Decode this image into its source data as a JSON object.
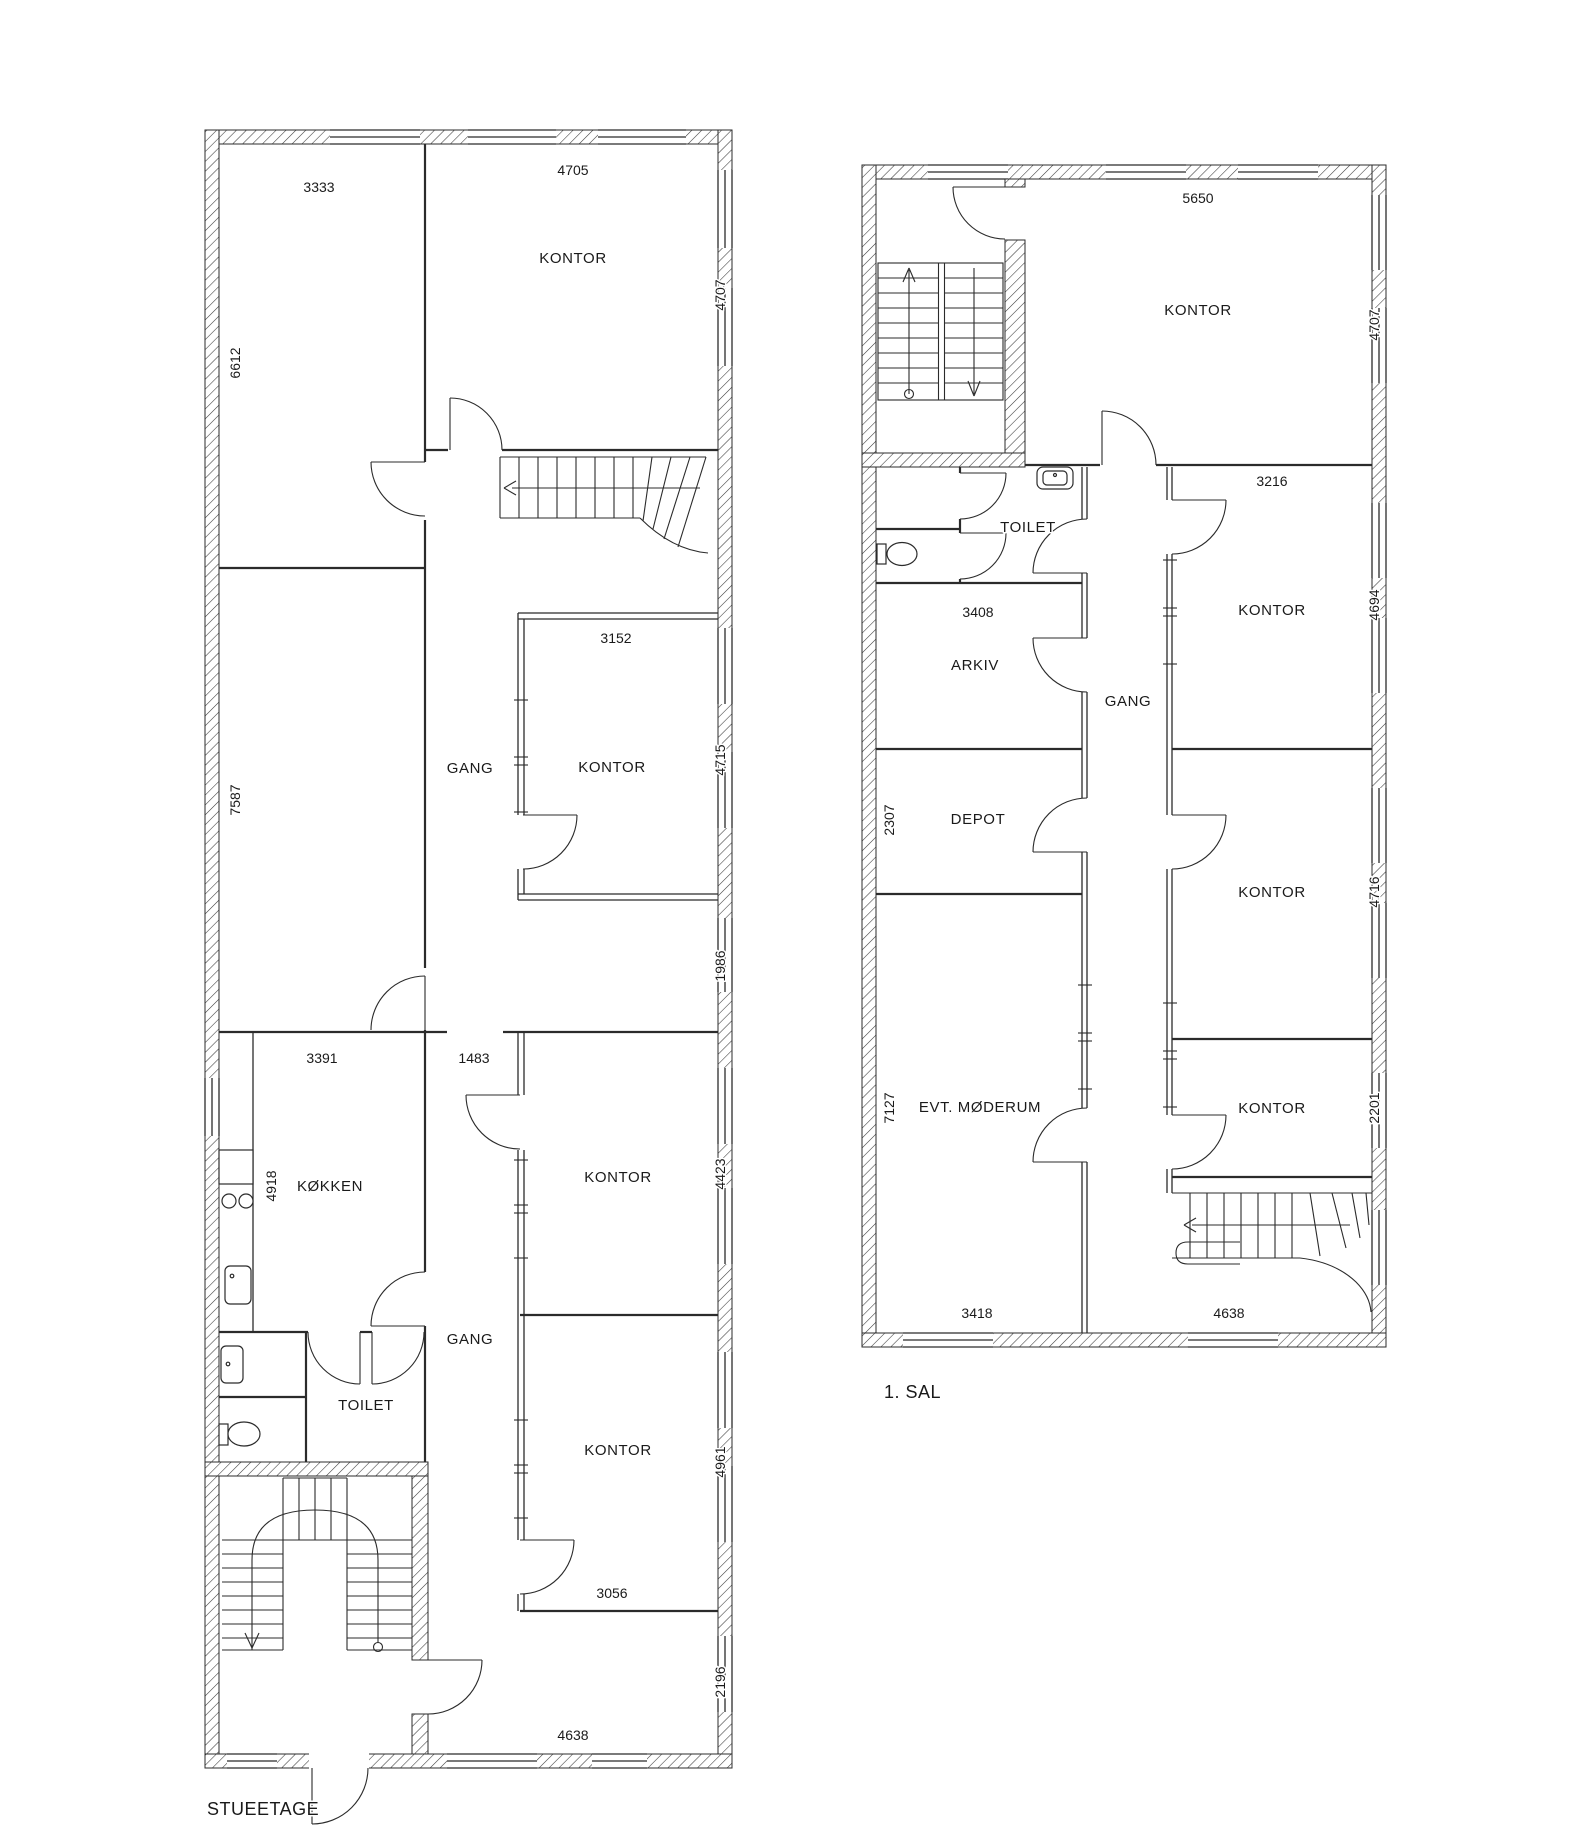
{
  "page": {
    "background": "#ffffff",
    "line_color": "#2b2b2b",
    "text_color": "#1a1a1a"
  },
  "ground": {
    "title": "STUEETAGE",
    "rooms": {
      "kontor_ne": "KONTOR",
      "kontor_inner": "KONTOR",
      "kontor_mid": "KONTOR",
      "kontor_low": "KONTOR",
      "kokken": "KØKKEN",
      "toilet": "TOILET",
      "gang_upper": "GANG",
      "gang_lower": "GANG"
    },
    "dims": {
      "room_nw_w": "3333",
      "room_nw_h": "6612",
      "kontor_ne_w": "4705",
      "kontor_ne_h": "4707",
      "room_w_h": "7587",
      "kontor_inner_w": "3152",
      "kontor_inner_h": "4715",
      "gang_mid_h": "1986",
      "kokken_w": "3391",
      "kokken_h": "4918",
      "hall_w": "1483",
      "kontor_mid_h": "4423",
      "kontor_low_h": "4961",
      "kontor_low_w": "3056",
      "hall_s_h": "2196",
      "south_w": "4638"
    }
  },
  "first": {
    "title": "1. SAL",
    "rooms": {
      "kontor_n": "KONTOR",
      "toilet": "TOILET",
      "arkiv": "ARKIV",
      "depot": "DEPOT",
      "moderum": "EVT. MØDERUM",
      "gang": "GANG",
      "kontor_e1": "KONTOR",
      "kontor_e2": "KONTOR",
      "kontor_e3": "KONTOR"
    },
    "dims": {
      "kontor_n_w": "5650",
      "kontor_n_h": "4707",
      "arkiv_w": "3408",
      "depot_h": "2307",
      "moderum_h": "7127",
      "moderum_w": "3418",
      "kontor_e1_w": "3216",
      "kontor_e1_h": "4694",
      "kontor_e2_h": "4716",
      "kontor_e3_h": "2201",
      "south_w": "4638"
    }
  }
}
